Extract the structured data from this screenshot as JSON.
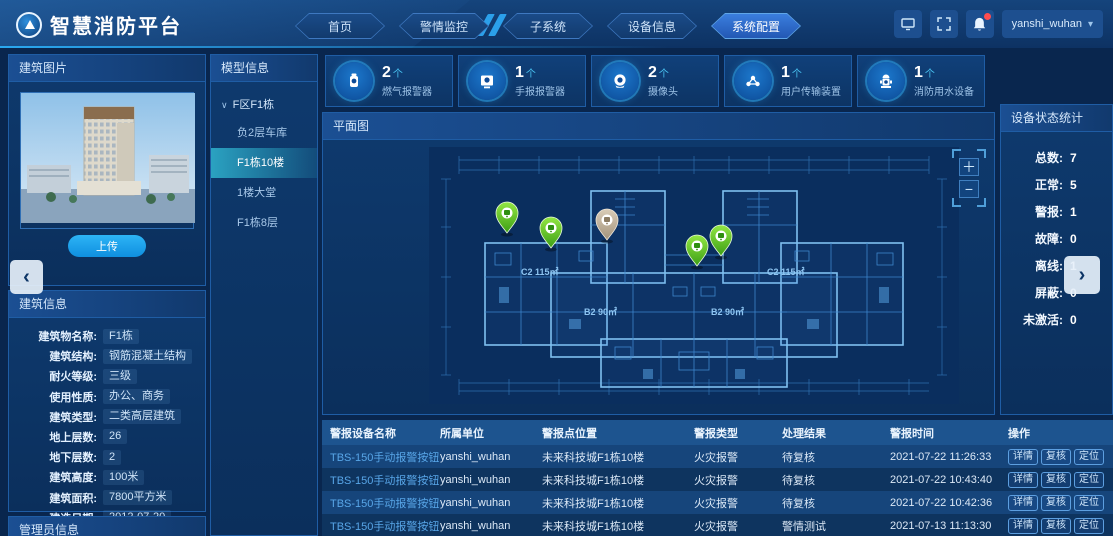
{
  "header": {
    "logo_title": "智慧消防平台",
    "nav_items": [
      "首页",
      "警情监控",
      "子系统",
      "设备信息",
      "系统配置"
    ],
    "active_nav": "系统配置",
    "username": "yanshi_wuhan"
  },
  "building_image_panel": {
    "title": "建筑图片",
    "upload_label": "上传"
  },
  "building_info_panel": {
    "title": "建筑信息",
    "fields": [
      {
        "label": "建筑物名称:",
        "value": "F1栋"
      },
      {
        "label": "建筑结构:",
        "value": "钢筋混凝土结构"
      },
      {
        "label": "耐火等级:",
        "value": "三级"
      },
      {
        "label": "使用性质:",
        "value": "办公、商务"
      },
      {
        "label": "建筑类型:",
        "value": "二类高层建筑"
      },
      {
        "label": "地上层数:",
        "value": "26"
      },
      {
        "label": "地下层数:",
        "value": "2"
      },
      {
        "label": "建筑高度:",
        "value": "100米"
      },
      {
        "label": "建筑面积:",
        "value": "7800平方米"
      },
      {
        "label": "建造日期:",
        "value": "2012-07-20"
      },
      {
        "label": "最大容纳人数:",
        "value": "3200"
      }
    ]
  },
  "admin_panel": {
    "title": "管理员信息"
  },
  "model_panel": {
    "title": "模型信息",
    "group_label": "F区F1栋",
    "items": [
      "负2层车库",
      "F1栋10楼",
      "1楼大堂",
      "F1栋8层"
    ],
    "selected_item": "F1栋10楼"
  },
  "stats_cards": [
    {
      "count": "2",
      "suffix": "个",
      "label": "燃气报警器",
      "icon": "gas-alarm-icon"
    },
    {
      "count": "1",
      "suffix": "个",
      "label": "手报报警器",
      "icon": "manual-alarm-icon"
    },
    {
      "count": "2",
      "suffix": "个",
      "label": "摄像头",
      "icon": "camera-icon"
    },
    {
      "count": "1",
      "suffix": "个",
      "label": "用户传输装置",
      "icon": "transmission-device-icon"
    },
    {
      "count": "1",
      "suffix": "个",
      "label": "消防用水设备",
      "icon": "fire-hydrant-icon"
    }
  ],
  "plan_panel": {
    "title": "平面图",
    "room_labels": [
      "C2 115㎡",
      "B2 90㎡",
      "B2 90㎡",
      "C2 115㎡"
    ],
    "markers": [
      {
        "status": "normal"
      },
      {
        "status": "normal"
      },
      {
        "status": "offline"
      },
      {
        "status": "normal"
      },
      {
        "status": "normal"
      }
    ]
  },
  "device_status_panel": {
    "title": "设备状态统计",
    "stats": [
      {
        "label": "总数:",
        "value": "7"
      },
      {
        "label": "正常:",
        "value": "5"
      },
      {
        "label": "警报:",
        "value": "1"
      },
      {
        "label": "故障:",
        "value": "0"
      },
      {
        "label": "离线:",
        "value": "1"
      },
      {
        "label": "屏蔽:",
        "value": "0"
      },
      {
        "label": "未激活:",
        "value": "0"
      }
    ]
  },
  "alarm_table": {
    "headers": [
      "警报设备名称",
      "所属单位",
      "警报点位置",
      "警报类型",
      "处理结果",
      "警报时间",
      "操作"
    ],
    "action_labels": [
      "详情",
      "复核",
      "定位"
    ],
    "rows": [
      {
        "name": "TBS-150手动报警按钮",
        "unit": "yanshi_wuhan",
        "location": "未来科技城F1栋10楼",
        "type": "火灾报警",
        "result": "待复核",
        "time": "2021-07-22 11:26:33"
      },
      {
        "name": "TBS-150手动报警按钮",
        "unit": "yanshi_wuhan",
        "location": "未来科技城F1栋10楼",
        "type": "火灾报警",
        "result": "待复核",
        "time": "2021-07-22 10:43:40"
      },
      {
        "name": "TBS-150手动报警按钮",
        "unit": "yanshi_wuhan",
        "location": "未来科技城F1栋10楼",
        "type": "火灾报警",
        "result": "待复核",
        "time": "2021-07-22 10:42:36"
      },
      {
        "name": "TBS-150手动报警按钮",
        "unit": "yanshi_wuhan",
        "location": "未来科技城F1栋10楼",
        "type": "火灾报警",
        "result": "警情测试",
        "time": "2021-07-13 11:13:30"
      }
    ]
  }
}
